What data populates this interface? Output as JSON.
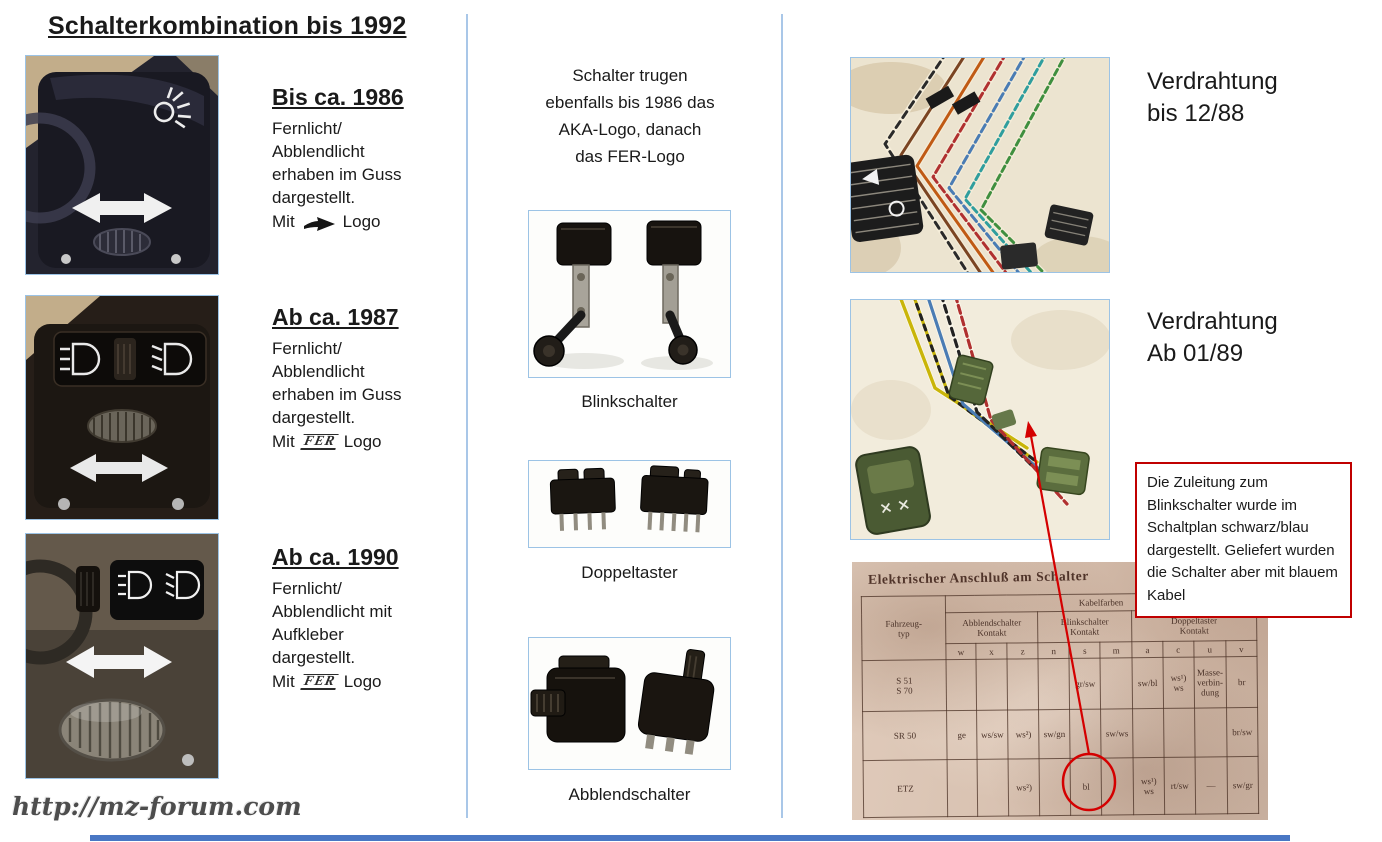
{
  "page": {
    "title": "Schalterkombination bis 1992",
    "watermark": "http://mz-forum.com"
  },
  "icons": {
    "aka_logo": "black-swoosh-arrow-right",
    "fer_logo_text": "FER"
  },
  "colors": {
    "photo_border_blue": "#9cc3e5",
    "divider_blue": "#a9c7e8",
    "footer_bar_blue": "#4977c4",
    "annotation_red": "#c00000"
  },
  "left_column": {
    "entries": [
      {
        "heading": "Bis ca. 1986",
        "lines": [
          "Fernlicht/",
          "Abblendlicht",
          "erhaben im Guss",
          "dargestellt."
        ],
        "mit_label": "Mit",
        "logo": "aka",
        "logo_label": "Logo"
      },
      {
        "heading": "Ab ca. 1987",
        "lines": [
          "Fernlicht/",
          "Abblendlicht",
          "erhaben im Guss",
          "dargestellt."
        ],
        "mit_label": "Mit",
        "logo": "fer",
        "logo_label": "Logo"
      },
      {
        "heading": "Ab ca. 1990",
        "lines": [
          "Fernlicht/",
          "Abblendlicht mit",
          "Aufkleber",
          "dargestellt."
        ],
        "mit_label": "Mit",
        "logo": "fer",
        "logo_label": "Logo"
      }
    ]
  },
  "middle_column": {
    "intro_lines": [
      "Schalter trugen",
      "ebenfalls bis 1986 das",
      "AKA-Logo, danach",
      "das FER-Logo"
    ],
    "labels": [
      "Blinkschalter",
      "Doppeltaster",
      "Abblendschalter"
    ]
  },
  "right_column": {
    "wiring_before": {
      "line1": "Verdrahtung",
      "line2": "bis 12/88"
    },
    "wiring_after": {
      "line1": "Verdrahtung",
      "line2": "Ab 01/89"
    },
    "note_box_text": "Die Zuleitung zum Blinkschalter wurde im Schaltplan schwarz/blau dargestellt. Geliefert wurden die Schalter aber mit blauem Kabel",
    "table_photo": {
      "title": "Elektrischer Anschluß am Schalter",
      "vehicle_header": "Fahrzeug-\ntyp",
      "kabelfarben_label": "Kabelfarben",
      "groups": [
        "Abblendschalter\nKontakt",
        "Blinkschalter\nKontakt",
        "Doppeltaster\nKontakt"
      ],
      "contact_letters": [
        "w",
        "x",
        "z",
        "n",
        "s",
        "m",
        "a",
        "c",
        "u",
        "v"
      ],
      "rows": [
        {
          "label": "S 51\nS 70",
          "cells": [
            "",
            "",
            "",
            "",
            "gr/sw",
            "",
            "sw/bl",
            "ws¹)\nws",
            "Masse-\nverbin-\ndung",
            "br"
          ]
        },
        {
          "label": "SR 50",
          "cells": [
            "ge",
            "ws/sw",
            "ws²)",
            "sw/gn",
            "",
            "sw/ws",
            "",
            "",
            "",
            "br/sw"
          ]
        },
        {
          "label": "ETZ",
          "cells": [
            "",
            "",
            "ws²)",
            "",
            "bl",
            "",
            "ws¹)\nws",
            "rt/sw",
            "—",
            "sw/gr"
          ]
        }
      ],
      "circled_value": "bl"
    }
  }
}
